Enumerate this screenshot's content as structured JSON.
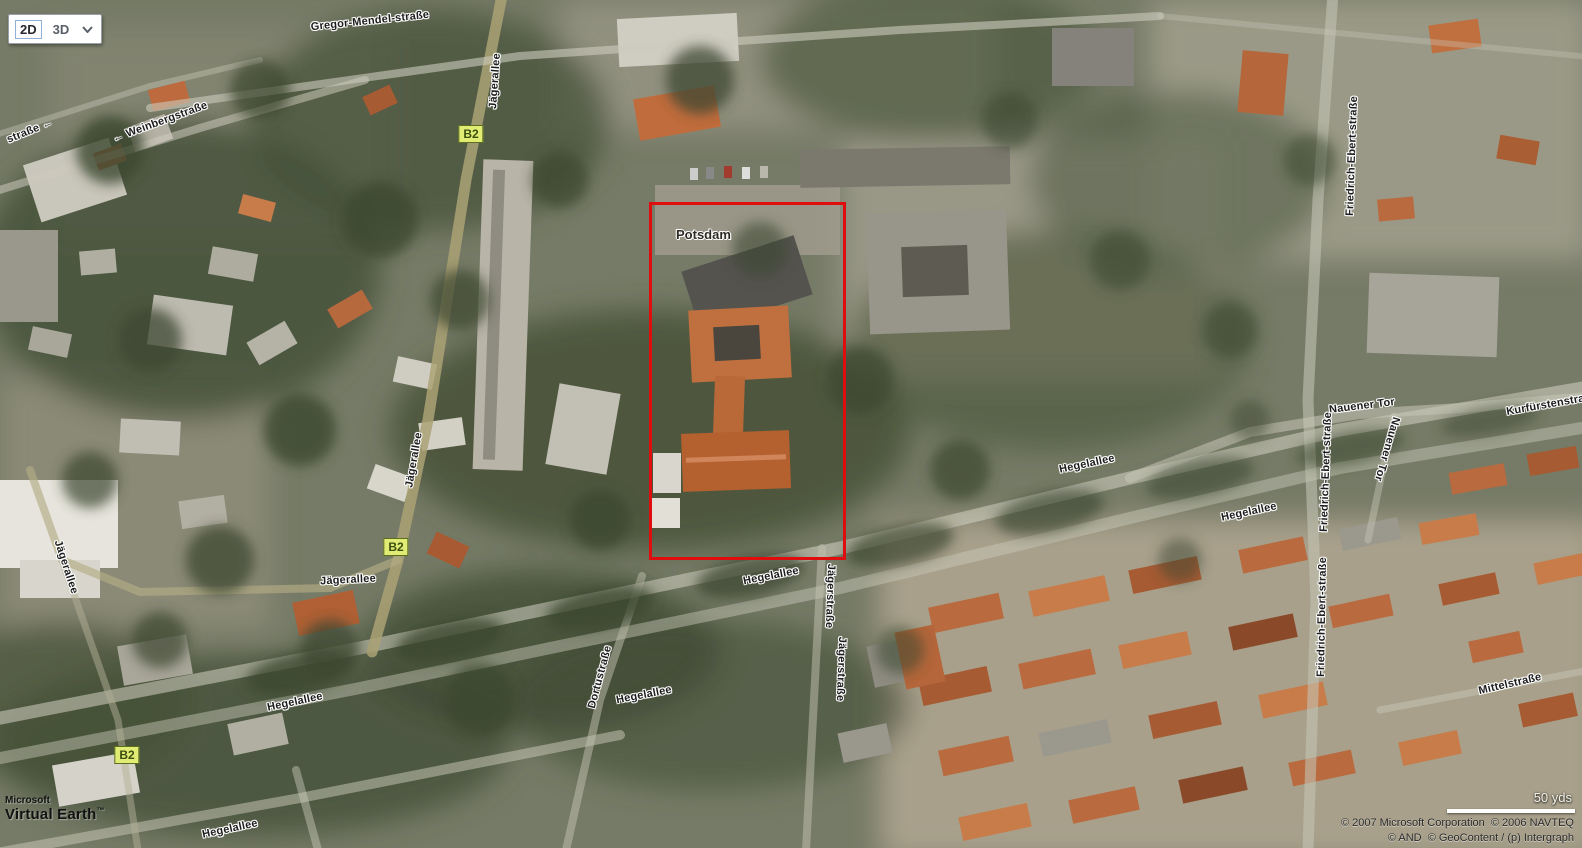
{
  "controls": {
    "map_mode": {
      "selected": "2D",
      "option_2d": "2D",
      "option_3d": "3D"
    }
  },
  "map": {
    "place_label": "Potsdam",
    "route_badge": "B2",
    "street_labels": [
      {
        "text": "Gregor-Mendel-straße"
      },
      {
        "text": "← Weinbergstraße"
      },
      {
        "text": "straße ←"
      },
      {
        "text": "Jägerallee"
      },
      {
        "text": "Jägerallee"
      },
      {
        "text": "Jägerallee"
      },
      {
        "text": "Jägerallee"
      },
      {
        "text": "Hegelallee"
      },
      {
        "text": "Hegelallee"
      },
      {
        "text": "Hegelallee"
      },
      {
        "text": "Hegelallee"
      },
      {
        "text": "Hegelallee"
      },
      {
        "text": "Hegelallee"
      },
      {
        "text": "Dortustraße"
      },
      {
        "text": "Jägerstraße"
      },
      {
        "text": "Jägerstraße"
      },
      {
        "text": "Nauener Tor"
      },
      {
        "text": "Nauener Tor"
      },
      {
        "text": "Kurfürstenstraße"
      },
      {
        "text": "Friedrich-Ebert-straße"
      },
      {
        "text": "Friedrich-Ebert-straße"
      },
      {
        "text": "Friedrich-Ebert-straße"
      },
      {
        "text": "Mittelstraße"
      }
    ]
  },
  "scale": {
    "label": "50 yds"
  },
  "attribution": {
    "brand_line1": "Microsoft",
    "brand_line2": "Virtual Earth",
    "brand_tm": "™",
    "copyright_line1": "© 2007 Microsoft Corporation  © 2006 NAVTEQ",
    "copyright_line2": "© AND  © GeoContent / (p) Intergraph"
  },
  "colors": {
    "highlight_red": "#df0d0d",
    "route_badge_bg": "#e0ec74",
    "route_badge_text": "#3c4f0d"
  }
}
